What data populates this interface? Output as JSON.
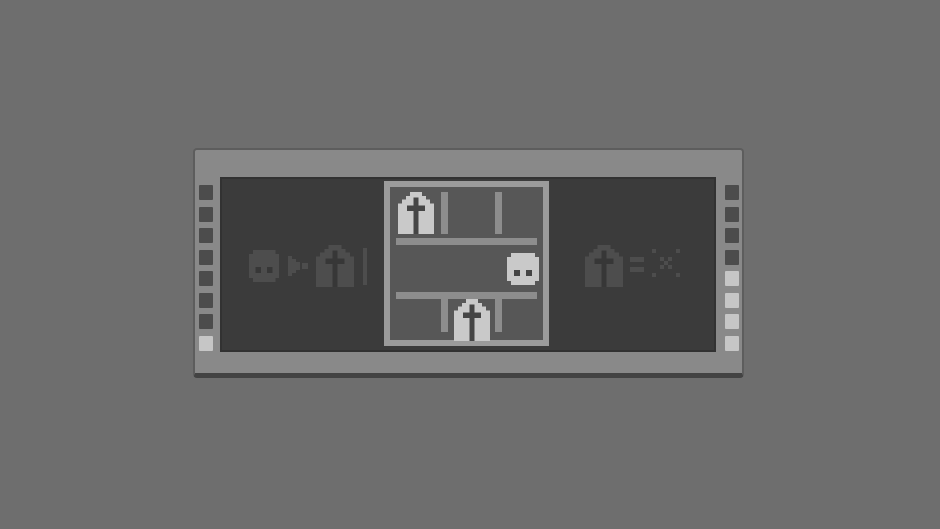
{
  "window": {
    "kind": "puzzle-rule-dialog"
  },
  "colors": {
    "page_bg": "#6e6e6e",
    "frame": "#898989",
    "frame_edge": "#5d5d5d",
    "frame_shadow": "#434343",
    "panel_bg": "#3b3b3b",
    "panel_edge": "#323232",
    "board_border": "#9b9b9b",
    "board_bg": "#575757",
    "wall": "#8d8d8d",
    "pip_dim": "#4c4c4c",
    "pip_lit": "#c6c6c6",
    "icon_lit": "#c9c9c9",
    "icon_lit_detail": "#454545",
    "icon_dim": "#4d4d4d",
    "icon_dim_detail": "#373737"
  },
  "progress_left": {
    "pips": [
      "dim",
      "dim",
      "dim",
      "dim",
      "dim",
      "dim",
      "dim",
      "lit"
    ]
  },
  "progress_right": {
    "pips": [
      "dim",
      "dim",
      "dim",
      "dim",
      "lit",
      "lit",
      "lit",
      "lit"
    ]
  },
  "rule_statement": {
    "icons": [
      "robot-face",
      "play-arrow",
      "chapel",
      "cursor-bar"
    ],
    "state": "dim"
  },
  "legend": {
    "icons": [
      "chapel",
      "equals",
      "x-mark"
    ],
    "state": "dim"
  },
  "board": {
    "rows": 3,
    "cols": 3,
    "cells": [
      {
        "row": 0,
        "col": 0,
        "icon": "chapel",
        "state": "lit"
      },
      {
        "row": 1,
        "col": 2,
        "icon": "robot-face",
        "state": "lit"
      },
      {
        "row": 2,
        "col": 1,
        "icon": "chapel",
        "state": "lit"
      }
    ],
    "wall_segments": [
      "h-top",
      "h-bottom",
      "v-left-top",
      "v-right-top",
      "v-left-bottom",
      "v-right-bottom"
    ]
  }
}
